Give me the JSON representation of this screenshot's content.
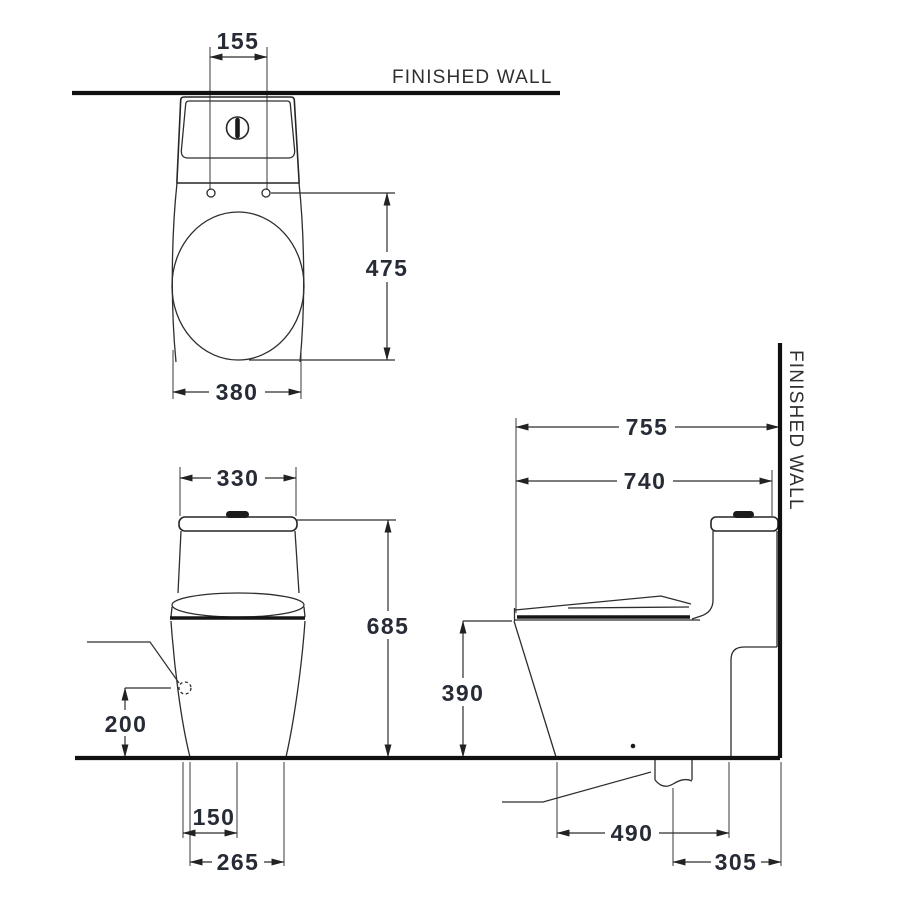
{
  "drawing": {
    "wall_label_top": "FINISHED  WALL",
    "wall_label_side": "FINISHED  WALL",
    "top_view": {
      "tank_holes_span": "155",
      "bowl_length": "475",
      "overall_width": "380"
    },
    "front_view": {
      "tank_width": "330",
      "overall_height": "685",
      "inlet_height": "200",
      "inlet_offset": "150",
      "foot_width": "265"
    },
    "side_view": {
      "depth_to_wall": "755",
      "depth_overall": "740",
      "rim_height": "390",
      "outlet_to_front": "490",
      "outlet_to_wall": "305"
    },
    "colors": {
      "line": "#2e2e2e",
      "heavy_line": "#111111",
      "dimension_text": "#262b36",
      "background": "#ffffff"
    }
  }
}
